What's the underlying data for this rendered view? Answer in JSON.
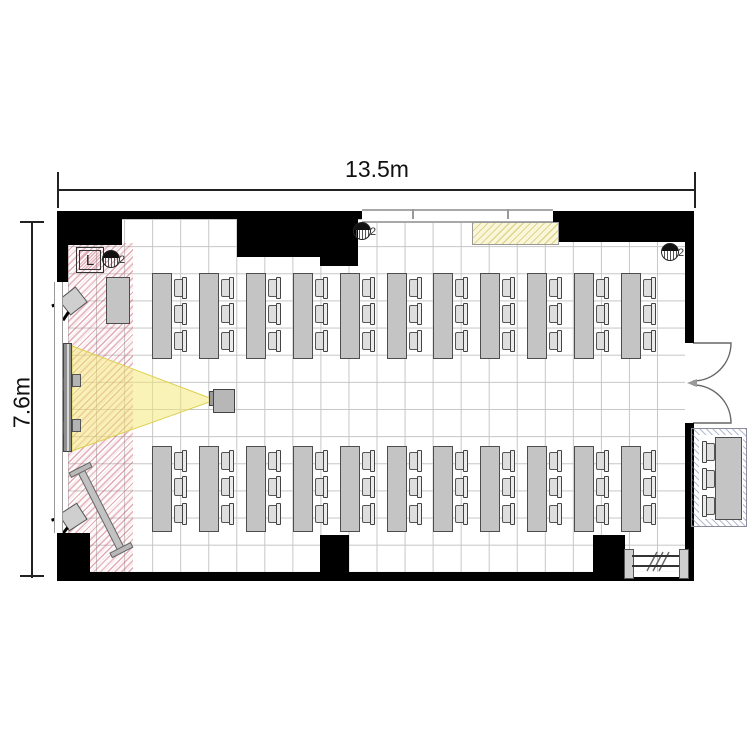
{
  "page": {
    "type": "architectural floor plan of a seminar / classroom",
    "background": "#ffffff"
  },
  "dimensions": {
    "width_label": "13.5m",
    "height_label": "7.6m"
  },
  "stage": {
    "lectern_label": "L"
  },
  "fixtures": {
    "labels": [
      "2",
      "2",
      "2"
    ]
  },
  "seating": {
    "rows": [
      {
        "position": "front",
        "tables": 11,
        "chairs_per_table": 3
      },
      {
        "position": "back",
        "tables": 11,
        "chairs_per_table": 3
      }
    ],
    "outside": {
      "tables": 1,
      "chairs": 3
    }
  },
  "equipment": [
    "projection-screen",
    "projector",
    "projection-beam",
    "mobile-whiteboard",
    "stage-table",
    "presenter-chairs",
    "double-door",
    "storage-cabinet"
  ],
  "colors": {
    "wall": "#000000",
    "grid": "#c6c6c6",
    "table_fill": "#c4c4c4",
    "stage_hatch": "#be465c",
    "outside_hatch": "#6c76a8",
    "cabinet_fill": "#faf6da",
    "beam_fill": "#f4e871"
  }
}
